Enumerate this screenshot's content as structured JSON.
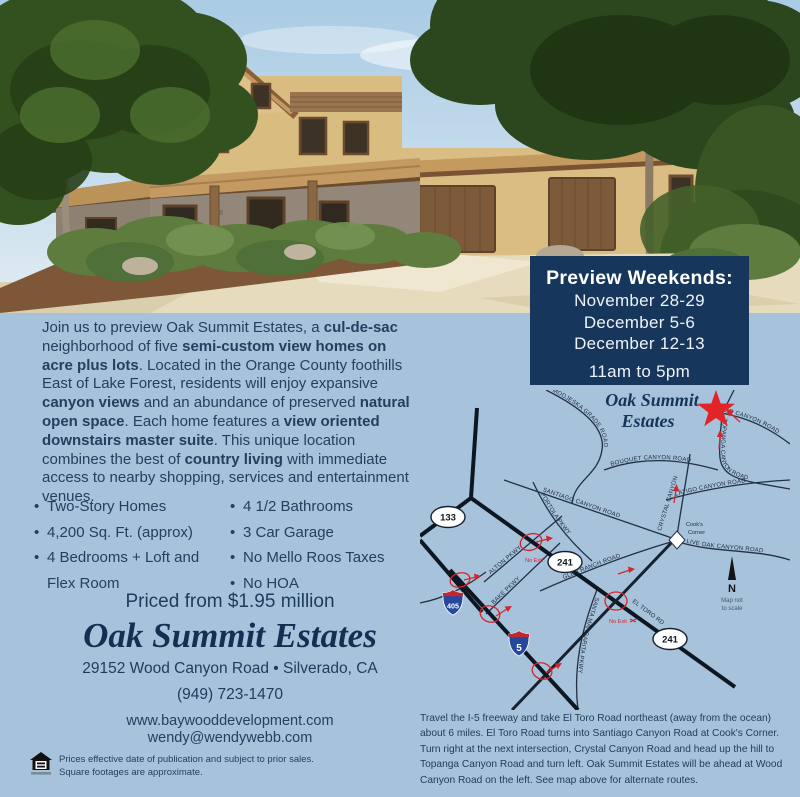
{
  "colors": {
    "background": "#a7c3db",
    "panel_navy": "#16365b",
    "accent_red": "#d7242b",
    "text_navy": "#1d3c5c"
  },
  "preview": {
    "title": "Preview Weekends:",
    "dates": [
      "November 28-29",
      "December 5-6",
      "December 12-13"
    ],
    "hours": "11am to 5pm"
  },
  "intro": {
    "segments": [
      {
        "t": "Join us to preview Oak Summit Estates, a ",
        "b": false
      },
      {
        "t": "cul-de-sac",
        "b": true
      },
      {
        "t": " neighborhood of five ",
        "b": false
      },
      {
        "t": "semi-custom view homes on acre plus lots",
        "b": true
      },
      {
        "t": ".  Located in the Orange County foothills East of Lake Forest, residents will enjoy expansive ",
        "b": false
      },
      {
        "t": "canyon views",
        "b": true
      },
      {
        "t": " and an abundance of preserved ",
        "b": false
      },
      {
        "t": "natural open space",
        "b": true
      },
      {
        "t": ". Each home features a ",
        "b": false
      },
      {
        "t": "view oriented downstairs master suite",
        "b": true
      },
      {
        "t": ". This unique location combines the best of ",
        "b": false
      },
      {
        "t": "country living",
        "b": true
      },
      {
        "t": " with immediate access to nearby shopping, services and entertainment venues.",
        "b": false
      }
    ]
  },
  "features": {
    "left": [
      "Two-Story Homes",
      "4,200 Sq. Ft. (approx)",
      "4 Bedrooms + Loft and Flex Room"
    ],
    "right": [
      "4 1/2 Bathrooms",
      "3 Car Garage",
      "No Mello Roos Taxes",
      "No HOA"
    ]
  },
  "offer": {
    "price": "Priced from $1.95 million",
    "name": "Oak Summit Estates",
    "address": "29152 Wood Canyon Road • Silverado, CA",
    "phone": "(949) 723-1470",
    "website": "www.baywooddevelopment.com",
    "email": "wendy@wendywebb.com"
  },
  "disclaimer": {
    "line1": "Prices effective date of publication and subject to prior sales.",
    "line2": "Square footages are approximate."
  },
  "map": {
    "title_line1": "Oak Summit",
    "title_line2": "Estates",
    "roads": {
      "modjeska": "MODJESKA GRADE ROAD",
      "wood": "WOOD CANYON ROAD",
      "topanga": "TOPANGA CANYON ROAD",
      "bouquet": "BOUQUET CANYON ROAD",
      "latigo": "LATIGO CANYON ROAD",
      "crystal": "CRYSTAL CANYON",
      "santiago": "SANTIAGO CANYON ROAD",
      "liveoak": "LIVE OAK CANYON ROAD",
      "glenranch": "GLEN RANCH ROAD",
      "portola": "PORTOLA PKWY",
      "alton": "ALTON PKWY",
      "bake": "BAKE PKWY",
      "santamargarita": "SANTA MARGARITA PKWY",
      "eltoro": "EL TORO RD"
    },
    "shields": {
      "s133": "133",
      "s241": "241",
      "i405": "405",
      "i5": "5"
    },
    "cooks_line1": "Cook's",
    "cooks_line2": "Corner",
    "no_exit": "No Exit",
    "compass_letter": "N",
    "scale_note_line1": "Map not",
    "scale_note_line2": "to scale"
  },
  "directions": "Travel the I-5 freeway and take El Toro Road northeast (away from the ocean) about 6 miles. El Toro Road turns into Santiago Canyon Road at Cook's Corner. Turn right at the next intersection, Crystal Canyon Road and head up the hill to Topanga Canyon Road and turn left. Oak Summit Estates will be ahead at Wood Canyon Road on the left. See map above for alternate routes."
}
